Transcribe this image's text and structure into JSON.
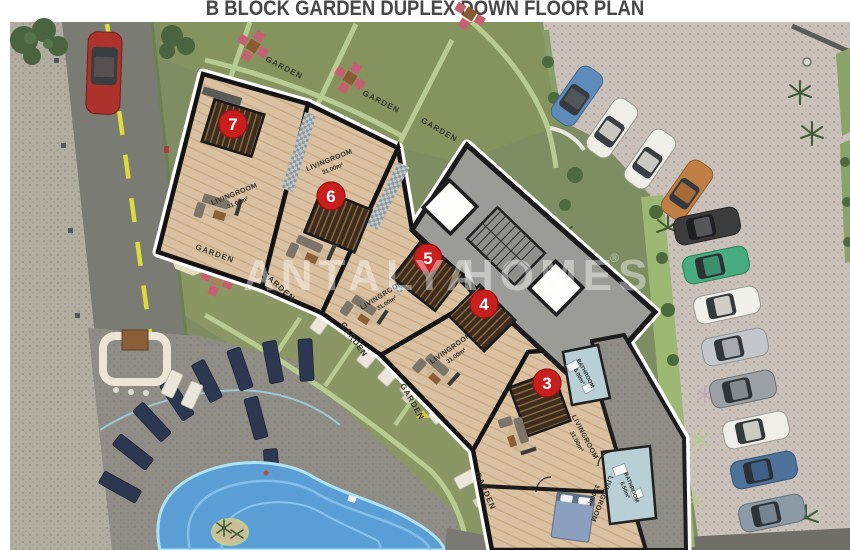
{
  "title": "B BLOCK GARDEN DUPLEX DOWN FLOOR PLAN",
  "watermark": {
    "part1": "ANTALYA",
    "part2": "HOMES",
    "reg": "®"
  },
  "labels": {
    "garden": "GARDEN"
  },
  "units": [
    {
      "number": "7",
      "room": "LIVINGROOM",
      "area": "31.00m²"
    },
    {
      "number": "6",
      "room": "LIVINGROOM",
      "area": "31.00m²"
    },
    {
      "number": "5",
      "room": "LIVINGROOM",
      "area": "31.00m²"
    },
    {
      "number": "4",
      "room": "LIVINGROOM",
      "area": "31.00m²"
    },
    {
      "number": "3",
      "room": "LIVINGROOM",
      "area": "31.00m²"
    }
  ],
  "extra_rooms": [
    {
      "name": "BATHROOM",
      "area": "5.00m²"
    },
    {
      "name": "LIVINGROOM",
      "area": "31.00m²"
    },
    {
      "name": "BATHROOM",
      "area": "6.50m²"
    }
  ],
  "colors": {
    "badge_red": "#c81e1e",
    "pool_blue": "#5b9ed6",
    "lawn_green": "#7f8e62",
    "wood_floor": "#d9c1a1",
    "asphalt": "#7a7b72",
    "parking_paving": "#c9c1ba"
  }
}
